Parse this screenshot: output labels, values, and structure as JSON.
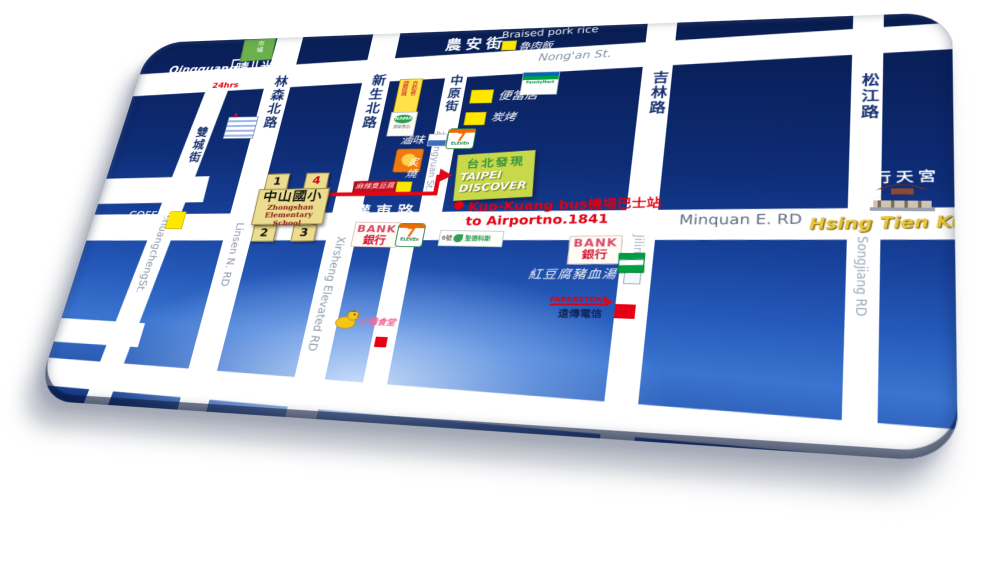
{
  "roads": {
    "nongan": {
      "zh": "農安街",
      "en": "Nong'an St."
    },
    "shuangcheng": {
      "zh": "雙城街",
      "en": "ShuangchengSt."
    },
    "linsen": {
      "zh": "林森北路",
      "en": "Linsen N. RD"
    },
    "xinsheng": {
      "zh": "新生北路",
      "elevated_en": "Xirsheng Elevated RD"
    },
    "zhongyuan": {
      "zh": "中原街",
      "en": "Zhongyuan St."
    },
    "jilin": {
      "zh": "吉林路",
      "en": "Jilin RD"
    },
    "songjiang": {
      "zh": "松江路",
      "en": "Songjiang RD"
    },
    "minquan": {
      "zh": "民權東路",
      "en": "Minquan E. RD"
    }
  },
  "pois": {
    "qingguang": {
      "en": "Qingguang",
      "zh1": "晴",
      "zh2": "光",
      "hours": "24hrs"
    },
    "market": {
      "zh": "市場"
    },
    "braised": {
      "en": "Braised pork rice",
      "zh": "魯肉飯"
    },
    "familymart": {
      "name": "FamilyMart"
    },
    "bento": {
      "zh": "便當店"
    },
    "bbq": {
      "zh": "炭烤"
    },
    "luwei": {
      "zh": "滷味"
    },
    "zhishao": {
      "zh": "炙燒"
    },
    "script_sign": {
      "zh": "麻辣臭豆腐"
    },
    "fried_sign": {
      "col1": "鹽酥雞",
      "col2": "自助餐"
    },
    "oval_sign": {
      "logo": "NAMA",
      "sub": "健康食品"
    },
    "seven": {
      "digit": "7",
      "word": "ELEVEn"
    },
    "school": {
      "zh": "中山國小",
      "en1": "Zhongshan",
      "en2": "Elementary School",
      "n1": "1",
      "n2": "2",
      "n3": "3",
      "n4": "4"
    },
    "coffee": {
      "l1": "COFFEE",
      "l2": "CAFE"
    },
    "discover": {
      "zh": "台北發現",
      "en1": "TAIPEI",
      "en2": "DISCOVER"
    },
    "kuokuang": {
      "line1": "Kuo-Kuang bus機場巴士站",
      "line2": "to Airportno.1841"
    },
    "bank": {
      "en": "BANK",
      "zh": "銀行"
    },
    "health": {
      "prefix": "6號",
      "name": "聖德科斯"
    },
    "tofu": {
      "zh": "紅豆腐豬血湯"
    },
    "fareastone": {
      "en": "FAREASTONE",
      "zh": "遠傳電信"
    },
    "duck": {
      "zh": "小鴨食堂"
    },
    "temple": {
      "zh": "行天宮",
      "en": "Hsing Tien Kung"
    }
  },
  "colors": {
    "panel_navy": "#0a2260",
    "panel_blue": "#2458b8",
    "glow": "#d2e6ff",
    "road": "#ffffff",
    "marker_yellow": "#ffe800",
    "route_red": "#e30613",
    "discover_bg": "#c8d84a",
    "school_bg": "#ecdc8f",
    "temple_gold": "#e8c53a"
  }
}
